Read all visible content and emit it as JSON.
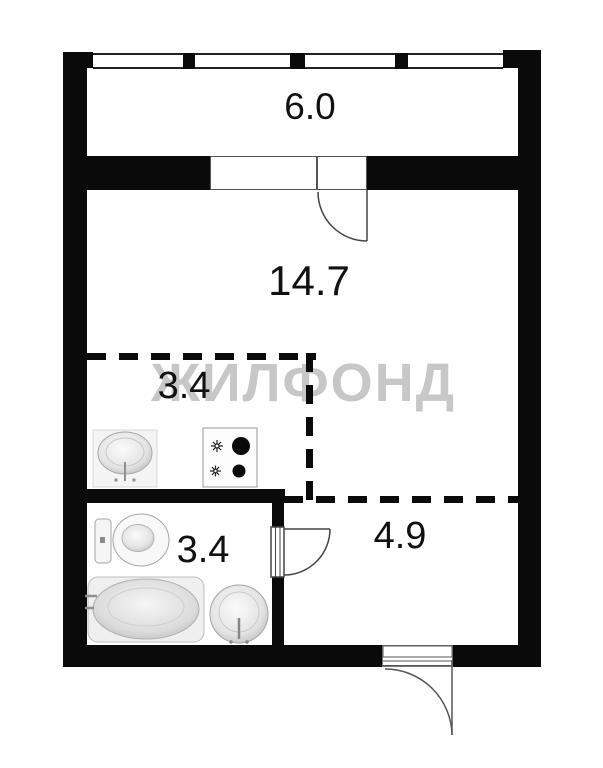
{
  "watermark_text": "ЖИЛФОНД",
  "colors": {
    "wall": "#0a0a0a",
    "watermark": "#c7c7c7",
    "background": "#ffffff",
    "thin_line": "#555555"
  },
  "rooms": {
    "balcony": {
      "area_label": "6.0"
    },
    "living_room": {
      "area_label": "14.7"
    },
    "kitchen": {
      "area_label": "3.4"
    },
    "bathroom": {
      "area_label": "3.4"
    },
    "hallway": {
      "area_label": "4.9"
    }
  },
  "fixtures": [
    "kitchen-sink-icon",
    "stove-icon",
    "toilet-icon",
    "bathtub-icon",
    "washbasin-icon"
  ],
  "doors": [
    "balcony-door",
    "bathroom-door",
    "entrance-door"
  ],
  "windows": [
    "balcony-glazing",
    "balcony-window-unit"
  ]
}
